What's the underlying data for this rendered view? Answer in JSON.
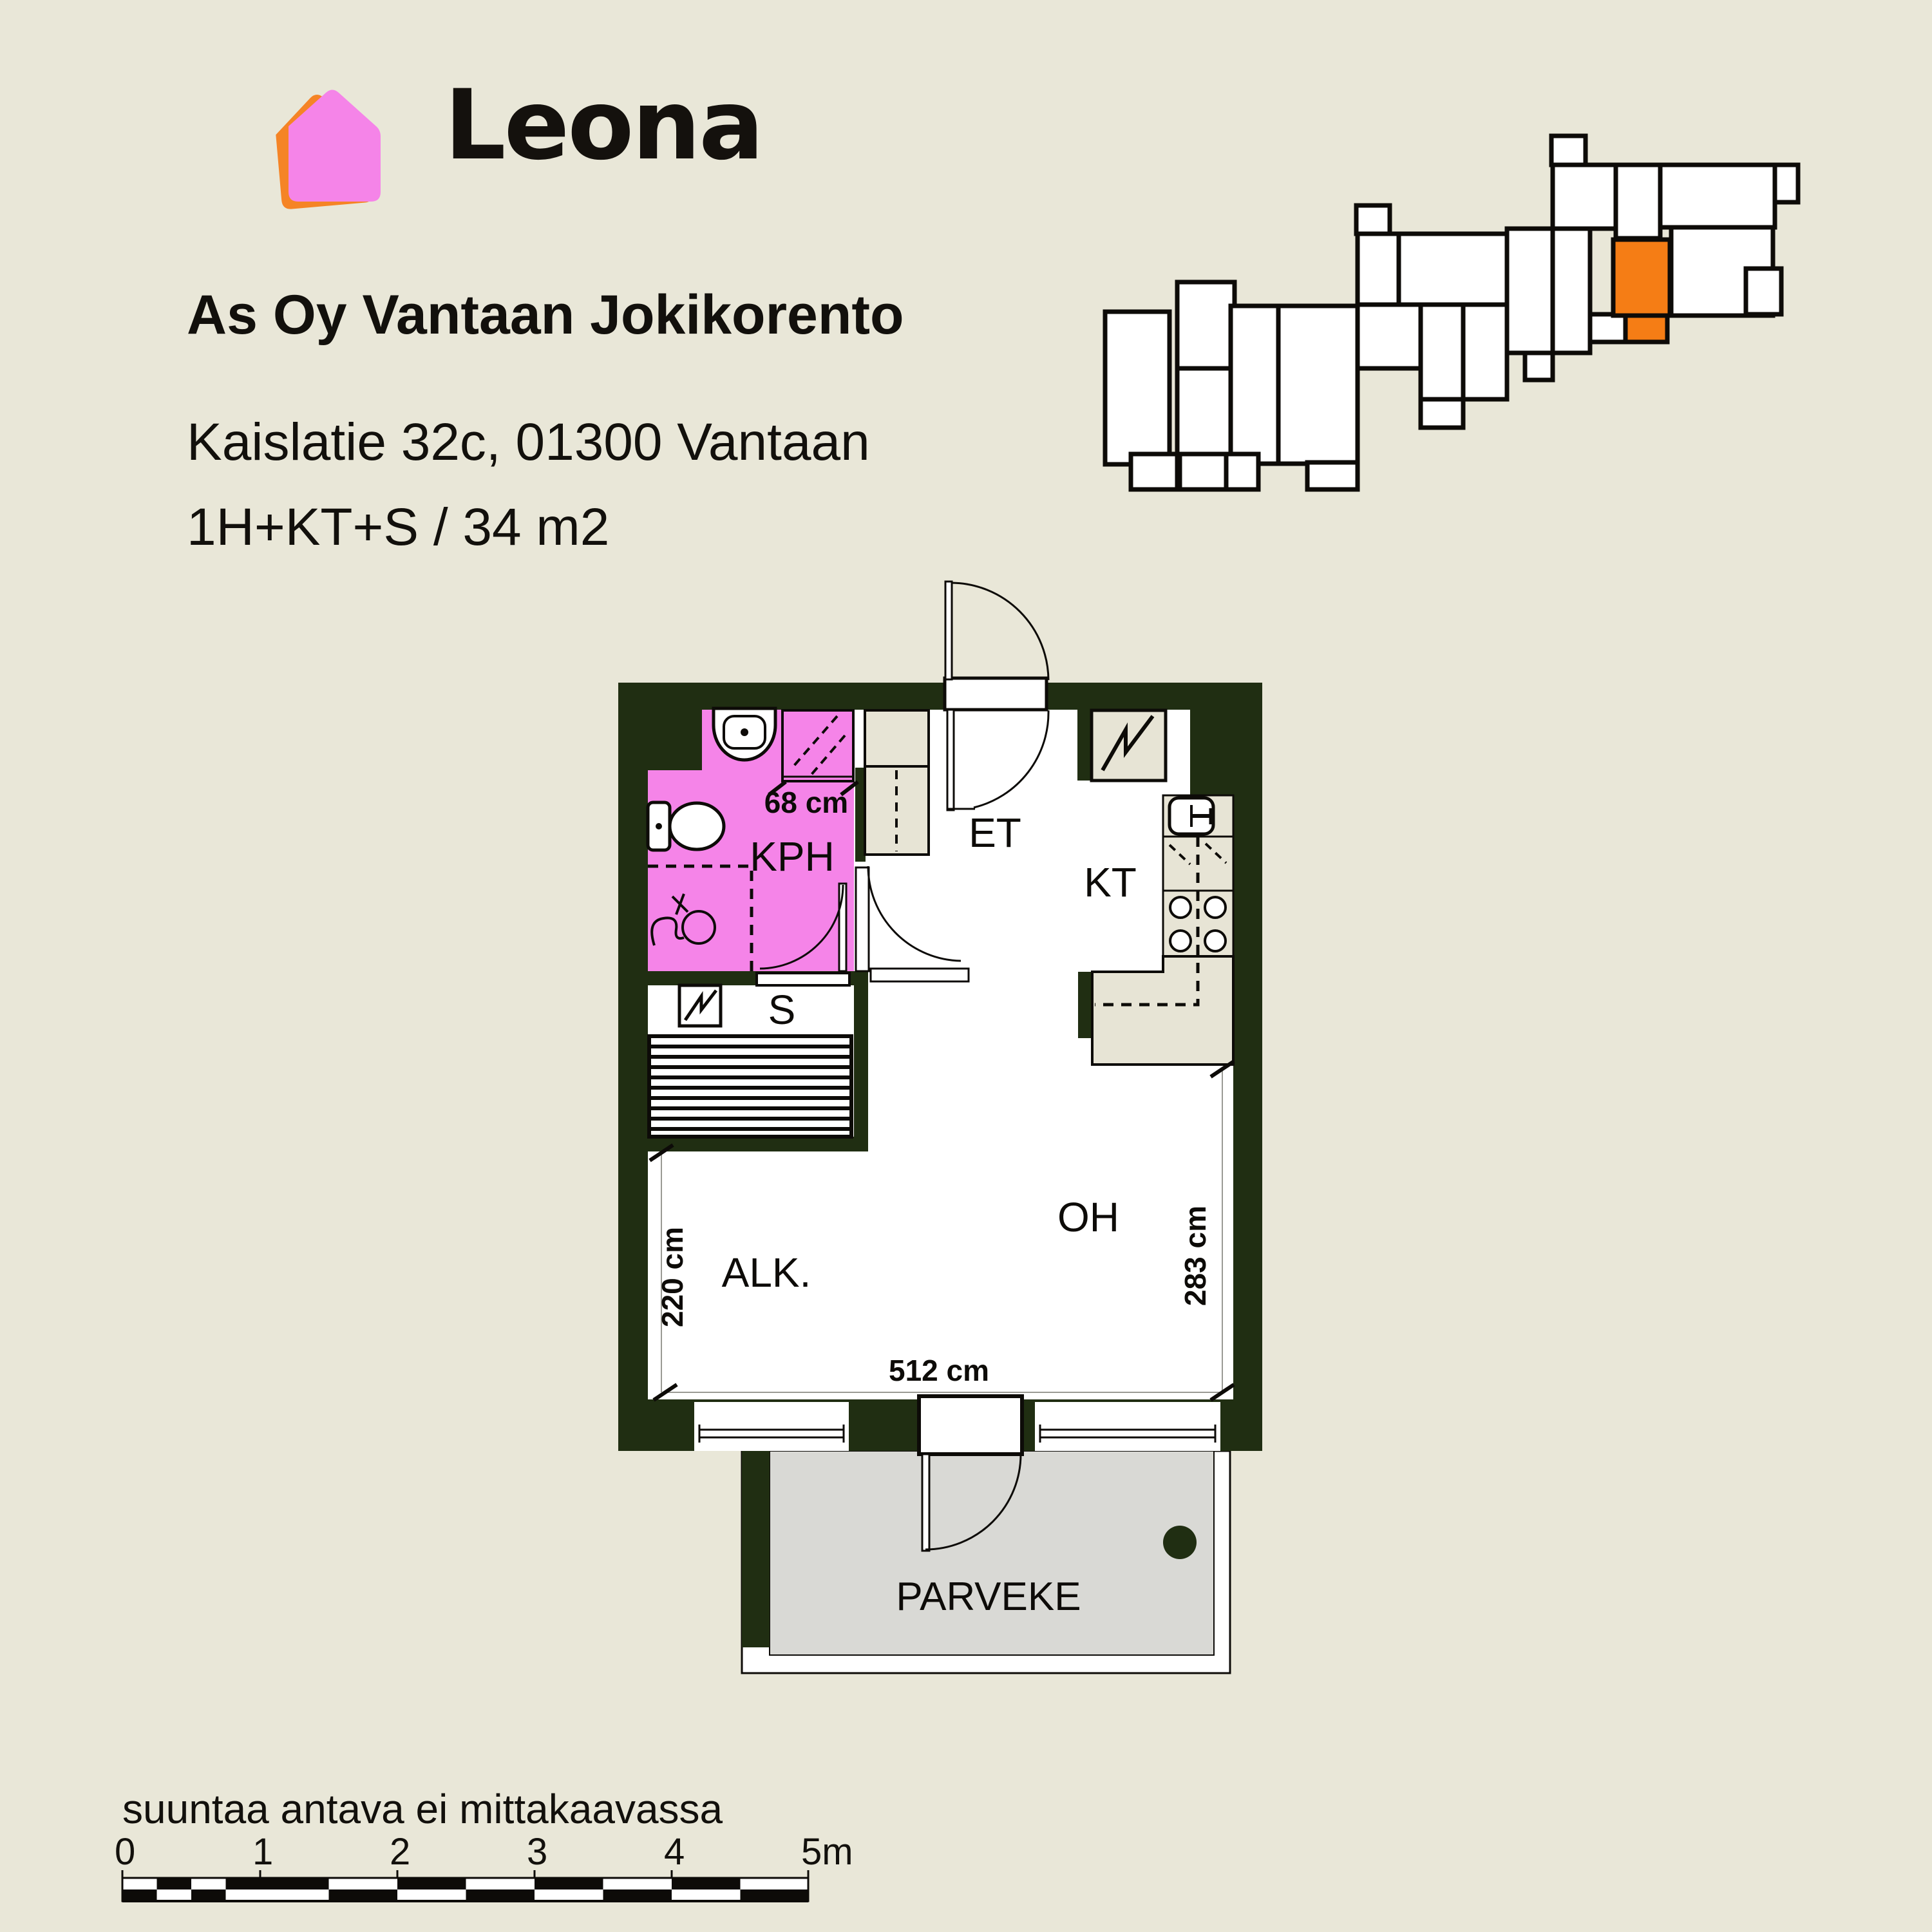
{
  "brand": {
    "logo_text": "Leona",
    "logo_icon": "house-icon",
    "logo_pink": "#f584e8",
    "logo_orange": "#f58426"
  },
  "header": {
    "title": "As Oy Vantaan Jokikorento",
    "address": "Kaislatie 32c, 01300 Vantaan",
    "apartment_info": "1H+KT+S / 34 m2"
  },
  "floor_plan": {
    "rooms": {
      "kph": "KPH",
      "s": "S",
      "et": "ET",
      "kt": "KT",
      "oh": "OH",
      "alk": "ALK.",
      "parveke": "PARVEKE"
    },
    "dimensions": {
      "shower_width": "68 cm",
      "alcove_depth": "220 cm",
      "living_depth": "283 cm",
      "room_width": "512 cm"
    },
    "colors": {
      "wall": "#202e12",
      "bathroom": "#f584e8",
      "cabinet": "#e7e4d5",
      "balcony_floor": "#d9d9d5",
      "floor": "#ffffff"
    },
    "fixtures": [
      "sink-icon",
      "shower-icon",
      "toilet-icon",
      "washing-machine-icon",
      "electrical-panel-icon",
      "kitchen-sink-icon",
      "dishwasher-icon",
      "stove-icon",
      "sauna-bench-icon",
      "balcony-drain-icon"
    ]
  },
  "site_plan": {
    "highlight_color": "#f57d15",
    "blocks": [
      [
        1716,
        484,
        100,
        237
      ],
      [
        1828,
        438,
        89,
        134
      ],
      [
        1828,
        572,
        83,
        149
      ],
      [
        1911,
        475,
        74,
        245
      ],
      [
        1985,
        475,
        123,
        245
      ],
      [
        1756,
        705,
        72,
        55
      ],
      [
        1832,
        705,
        72,
        55
      ],
      [
        1904,
        705,
        50,
        55
      ],
      [
        2030,
        718,
        78,
        42
      ],
      [
        2106,
        319,
        52,
        44
      ],
      [
        2108,
        363,
        64,
        110
      ],
      [
        2172,
        363,
        168,
        110
      ],
      [
        2340,
        355,
        71,
        193
      ],
      [
        2108,
        473,
        98,
        99
      ],
      [
        2206,
        473,
        66,
        147
      ],
      [
        2272,
        473,
        68,
        147
      ],
      [
        2368,
        548,
        43,
        42
      ],
      [
        2206,
        620,
        66,
        44
      ],
      [
        2409,
        211,
        53,
        45
      ],
      [
        2411,
        256,
        98,
        99
      ],
      [
        2509,
        256,
        69,
        114
      ],
      [
        2578,
        256,
        178,
        97
      ],
      [
        2756,
        256,
        36,
        58
      ],
      [
        2595,
        353,
        158,
        137
      ],
      [
        2711,
        417,
        55,
        71
      ],
      [
        2411,
        355,
        58,
        193
      ],
      [
        2469,
        488,
        55,
        43
      ]
    ],
    "highlight_blocks": [
      [
        2505,
        372,
        88,
        118
      ],
      [
        2524,
        490,
        65,
        41
      ]
    ]
  },
  "footer": {
    "disclaimer": "suuntaa antava ei mittakaavassa",
    "scale_labels": [
      "0",
      "1",
      "2",
      "3",
      "4",
      "5m"
    ]
  }
}
